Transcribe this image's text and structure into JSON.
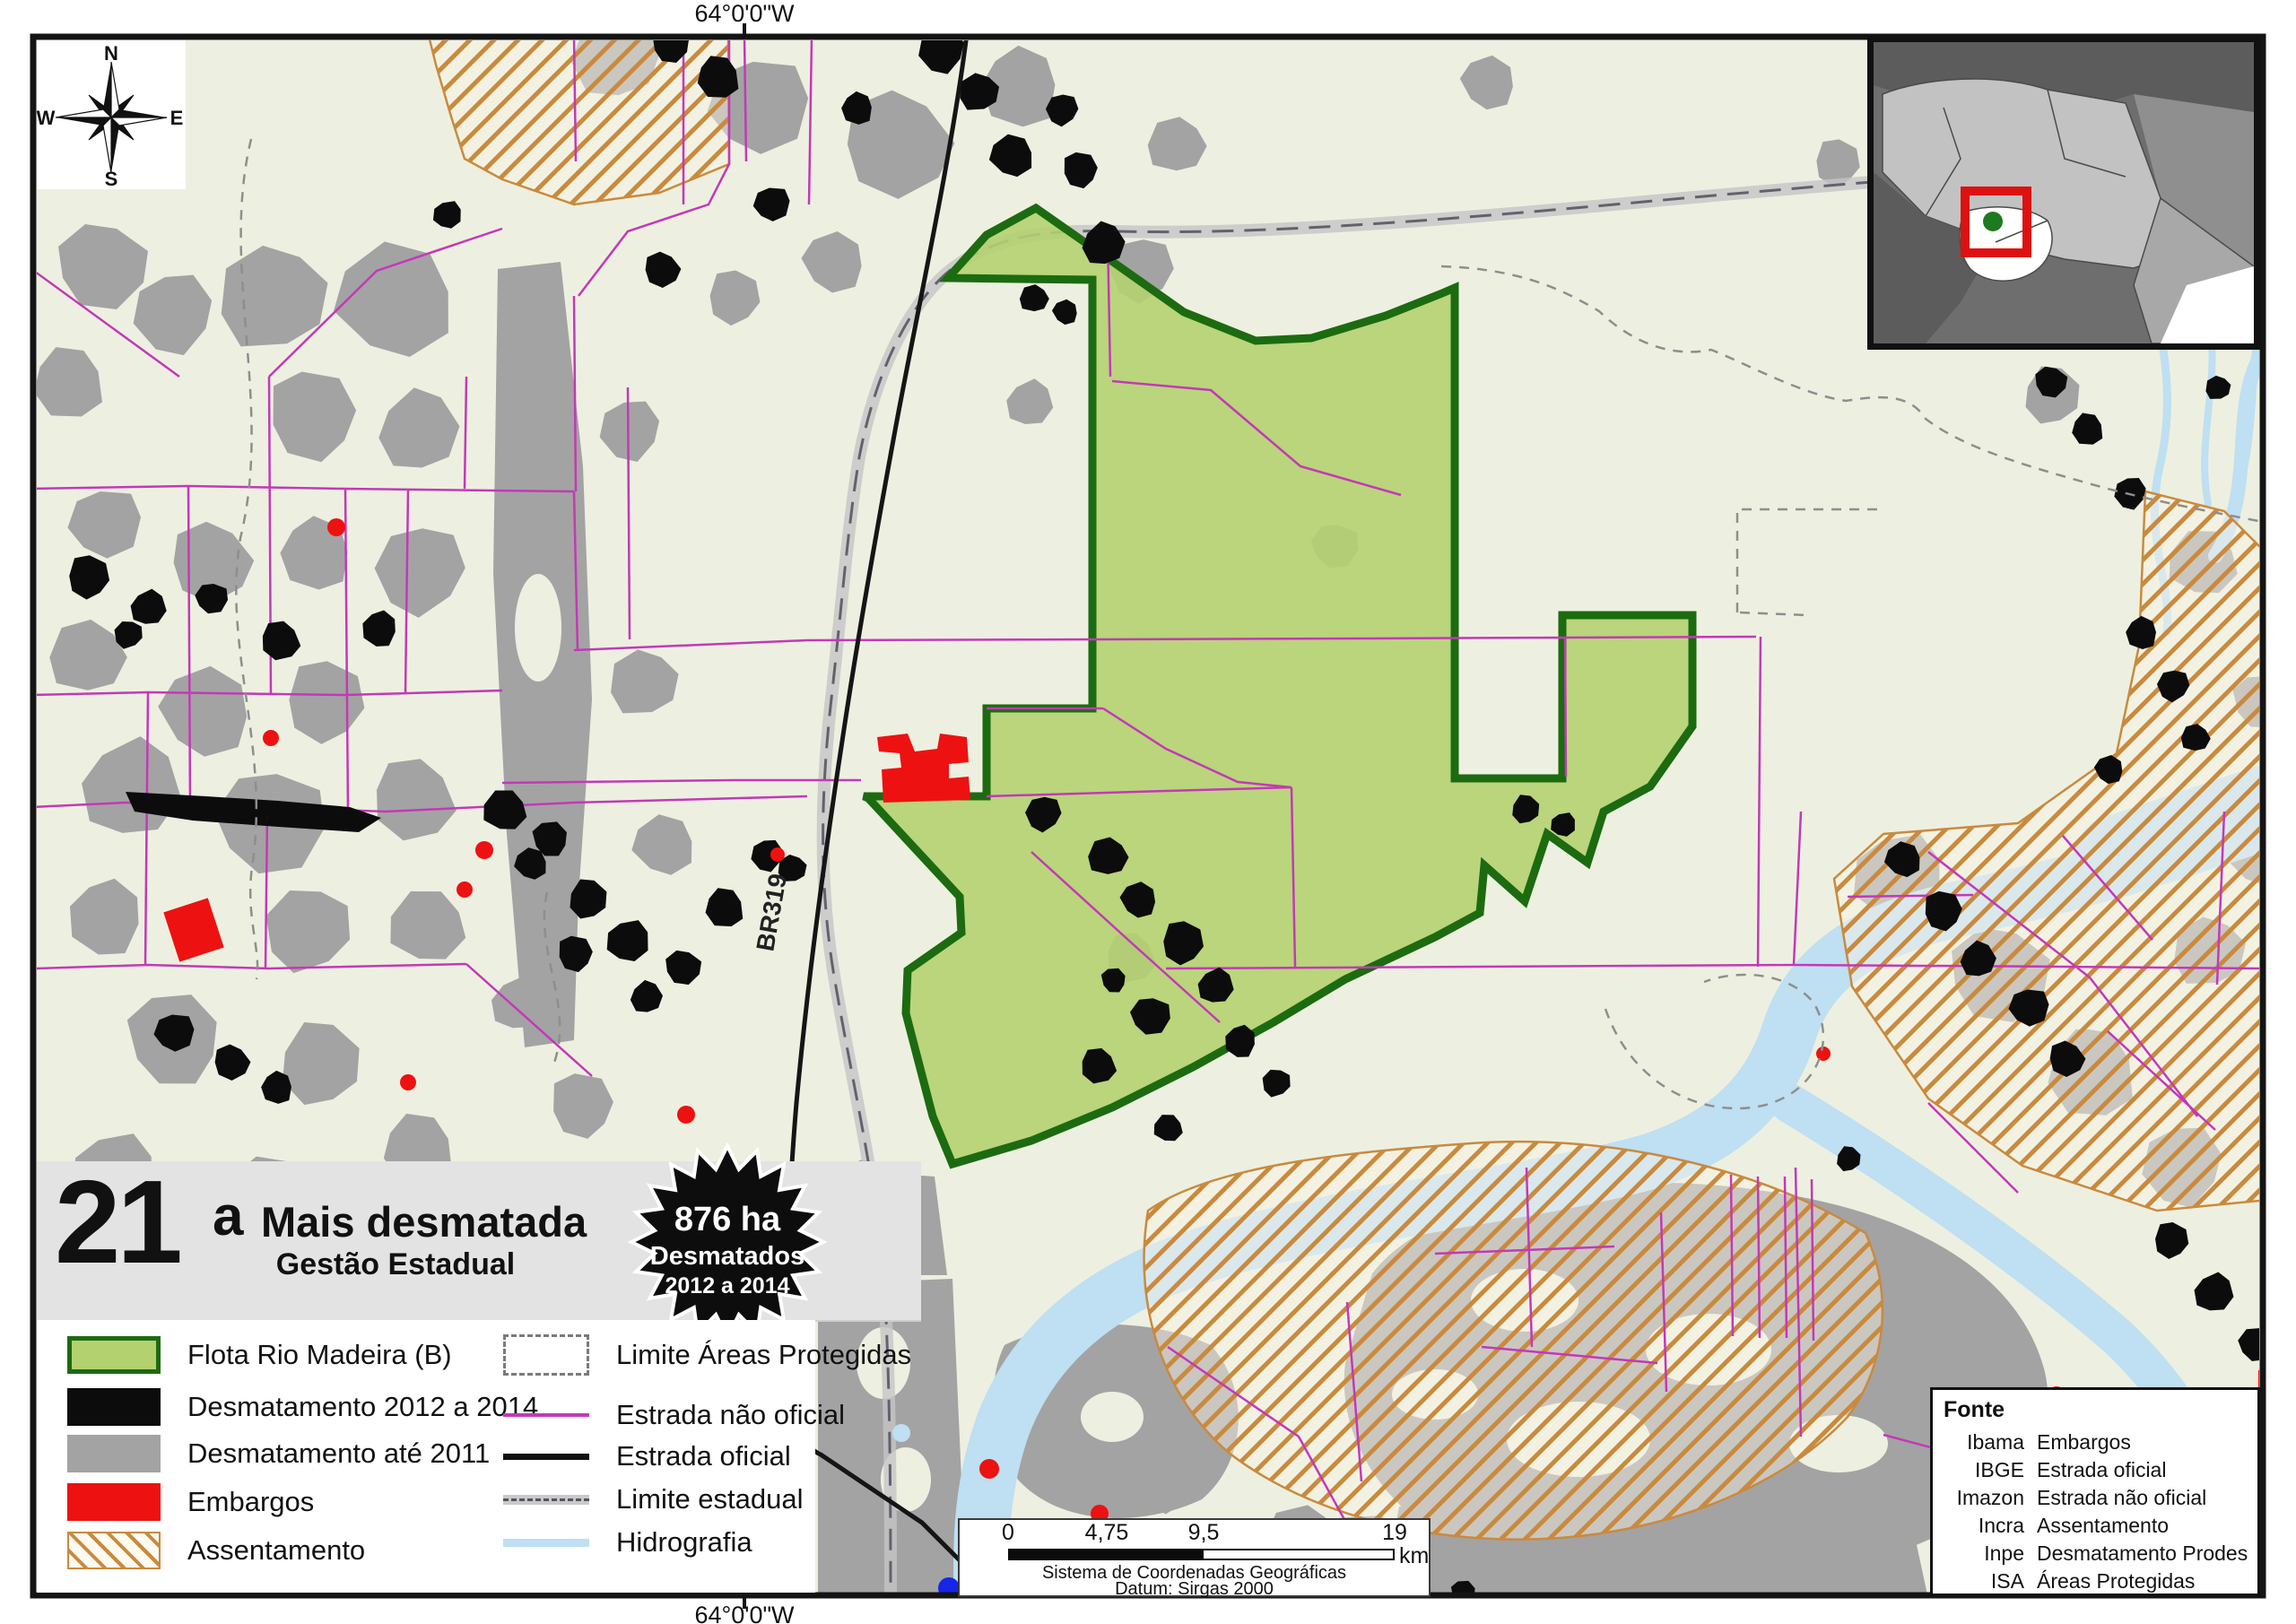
{
  "map": {
    "top_coordinate": "64°0'0\"W",
    "bottom_coordinate": "64°0'0\"W",
    "road_label": "BR319"
  },
  "compass": {
    "n": "N",
    "e": "E",
    "s": "S",
    "w": "W"
  },
  "title_panel": {
    "rank_number": "21",
    "rank_suffix": "a",
    "title": "Mais desmatada",
    "subtitle": "Gestão Estadual"
  },
  "badge": {
    "line1": "876 ha",
    "line2": "Desmatados",
    "line3": "2012 a 2014"
  },
  "legend": {
    "left": [
      {
        "label": "Flota Rio Madeira (B)"
      },
      {
        "label": "Desmatamento 2012 a 2014"
      },
      {
        "label": "Desmatamento até 2011"
      },
      {
        "label": "Embargos"
      },
      {
        "label": "Assentamento"
      }
    ],
    "right": [
      {
        "label": "Limite Áreas Protegidas"
      },
      {
        "label": "Estrada não oficial"
      },
      {
        "label": "Estrada oficial"
      },
      {
        "label": "Limite estadual"
      },
      {
        "label": "Hidrografia"
      }
    ]
  },
  "scalebar": {
    "tick0": "0",
    "tick1": "4,75",
    "tick2": "9,5",
    "tick3": "19",
    "unit": "km",
    "crs_line1": "Sistema de Coordenadas Geográficas",
    "crs_line2": "Datum: Sirgas 2000"
  },
  "fonte": {
    "title": "Fonte",
    "rows": [
      {
        "source": "Ibama",
        "dataset": "Embargos"
      },
      {
        "source": "IBGE",
        "dataset": "Estrada oficial"
      },
      {
        "source": "Imazon",
        "dataset": "Estrada não oficial"
      },
      {
        "source": "Incra",
        "dataset": "Assentamento"
      },
      {
        "source": "Inpe",
        "dataset": "Desmatamento Prodes"
      },
      {
        "source": "ISA",
        "dataset": "Áreas Protegidas"
      }
    ]
  },
  "colors": {
    "background": "#edf0e0",
    "flota_fill": "#b4d170",
    "flota_border": "#1c6b10",
    "deforestation_2012_2014": "#0c0c0c",
    "deforestation_until_2011": "#a3a3a3",
    "embargos": "#ee1111",
    "assentamento_hatch": "#c98a3e",
    "unofficial_road": "#c438b8",
    "official_road": "#151515",
    "state_limit_band": "#c4c4c6",
    "hydrography": "#bfdff2",
    "inset_highlight": "#dd1111",
    "inset_dot": "#1e7a1e"
  }
}
